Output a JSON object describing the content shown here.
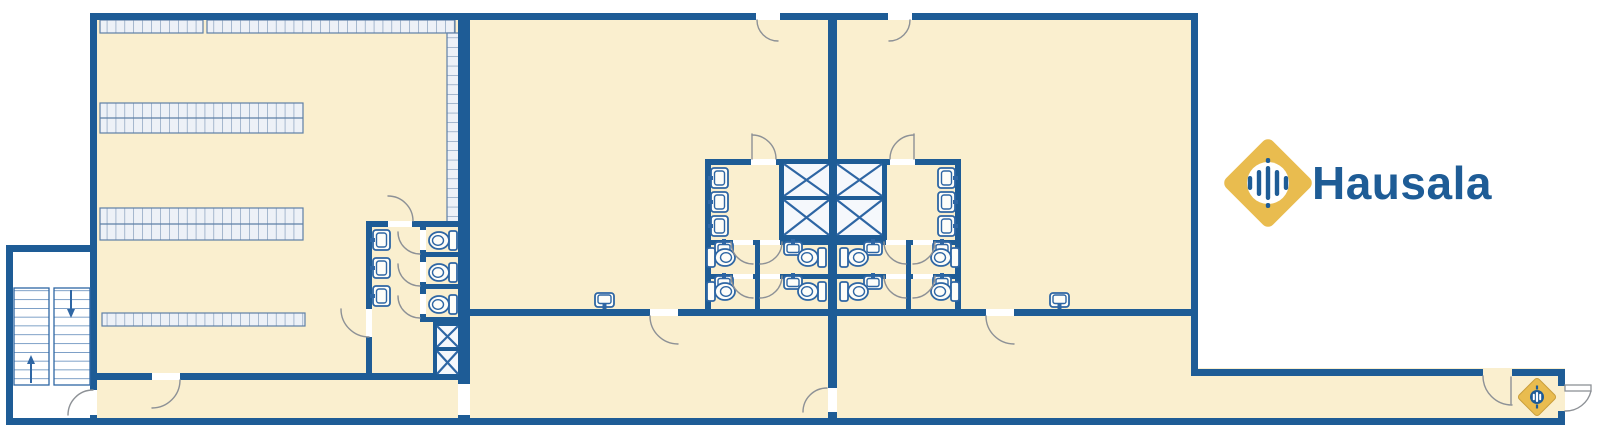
{
  "app": {
    "type": "architectural-floor-plan",
    "view": "single-floor-layout"
  },
  "brand": {
    "name": "Hausala"
  },
  "theme": {
    "colors": {
      "wall": "#1E5C96",
      "floor": "#FAEFCF",
      "fixture": "#2E66A4",
      "arcline": "#8D9196",
      "rackfill": "#EDF1F7",
      "rackline": "#5E7FA6",
      "shaftfill": "#F5F8FC",
      "gold": "#E9BC4F",
      "golddark": "#C99E3C",
      "background": "#FFFFFF"
    }
  },
  "floorplan": {
    "sections": [
      {
        "id": "warehouse-west",
        "features": {
          "pallet_rack_rows": 5,
          "stair_flights": 2,
          "wash_basins": 3,
          "toilet_stalls": 3,
          "elevator_shafts": 2,
          "doors": 6
        }
      },
      {
        "id": "hall-center",
        "features": {
          "wash_basins": 8,
          "toilet_stalls": 4,
          "elevator_shafts": 2,
          "doors": 5
        }
      },
      {
        "id": "hall-east",
        "features": {
          "wash_basins": 8,
          "toilet_stalls": 4,
          "elevator_shafts": 2,
          "doors": 5
        }
      },
      {
        "id": "corridor-south",
        "features": {
          "doors": 2,
          "exit_door": true,
          "brand_marker": true
        }
      }
    ]
  }
}
